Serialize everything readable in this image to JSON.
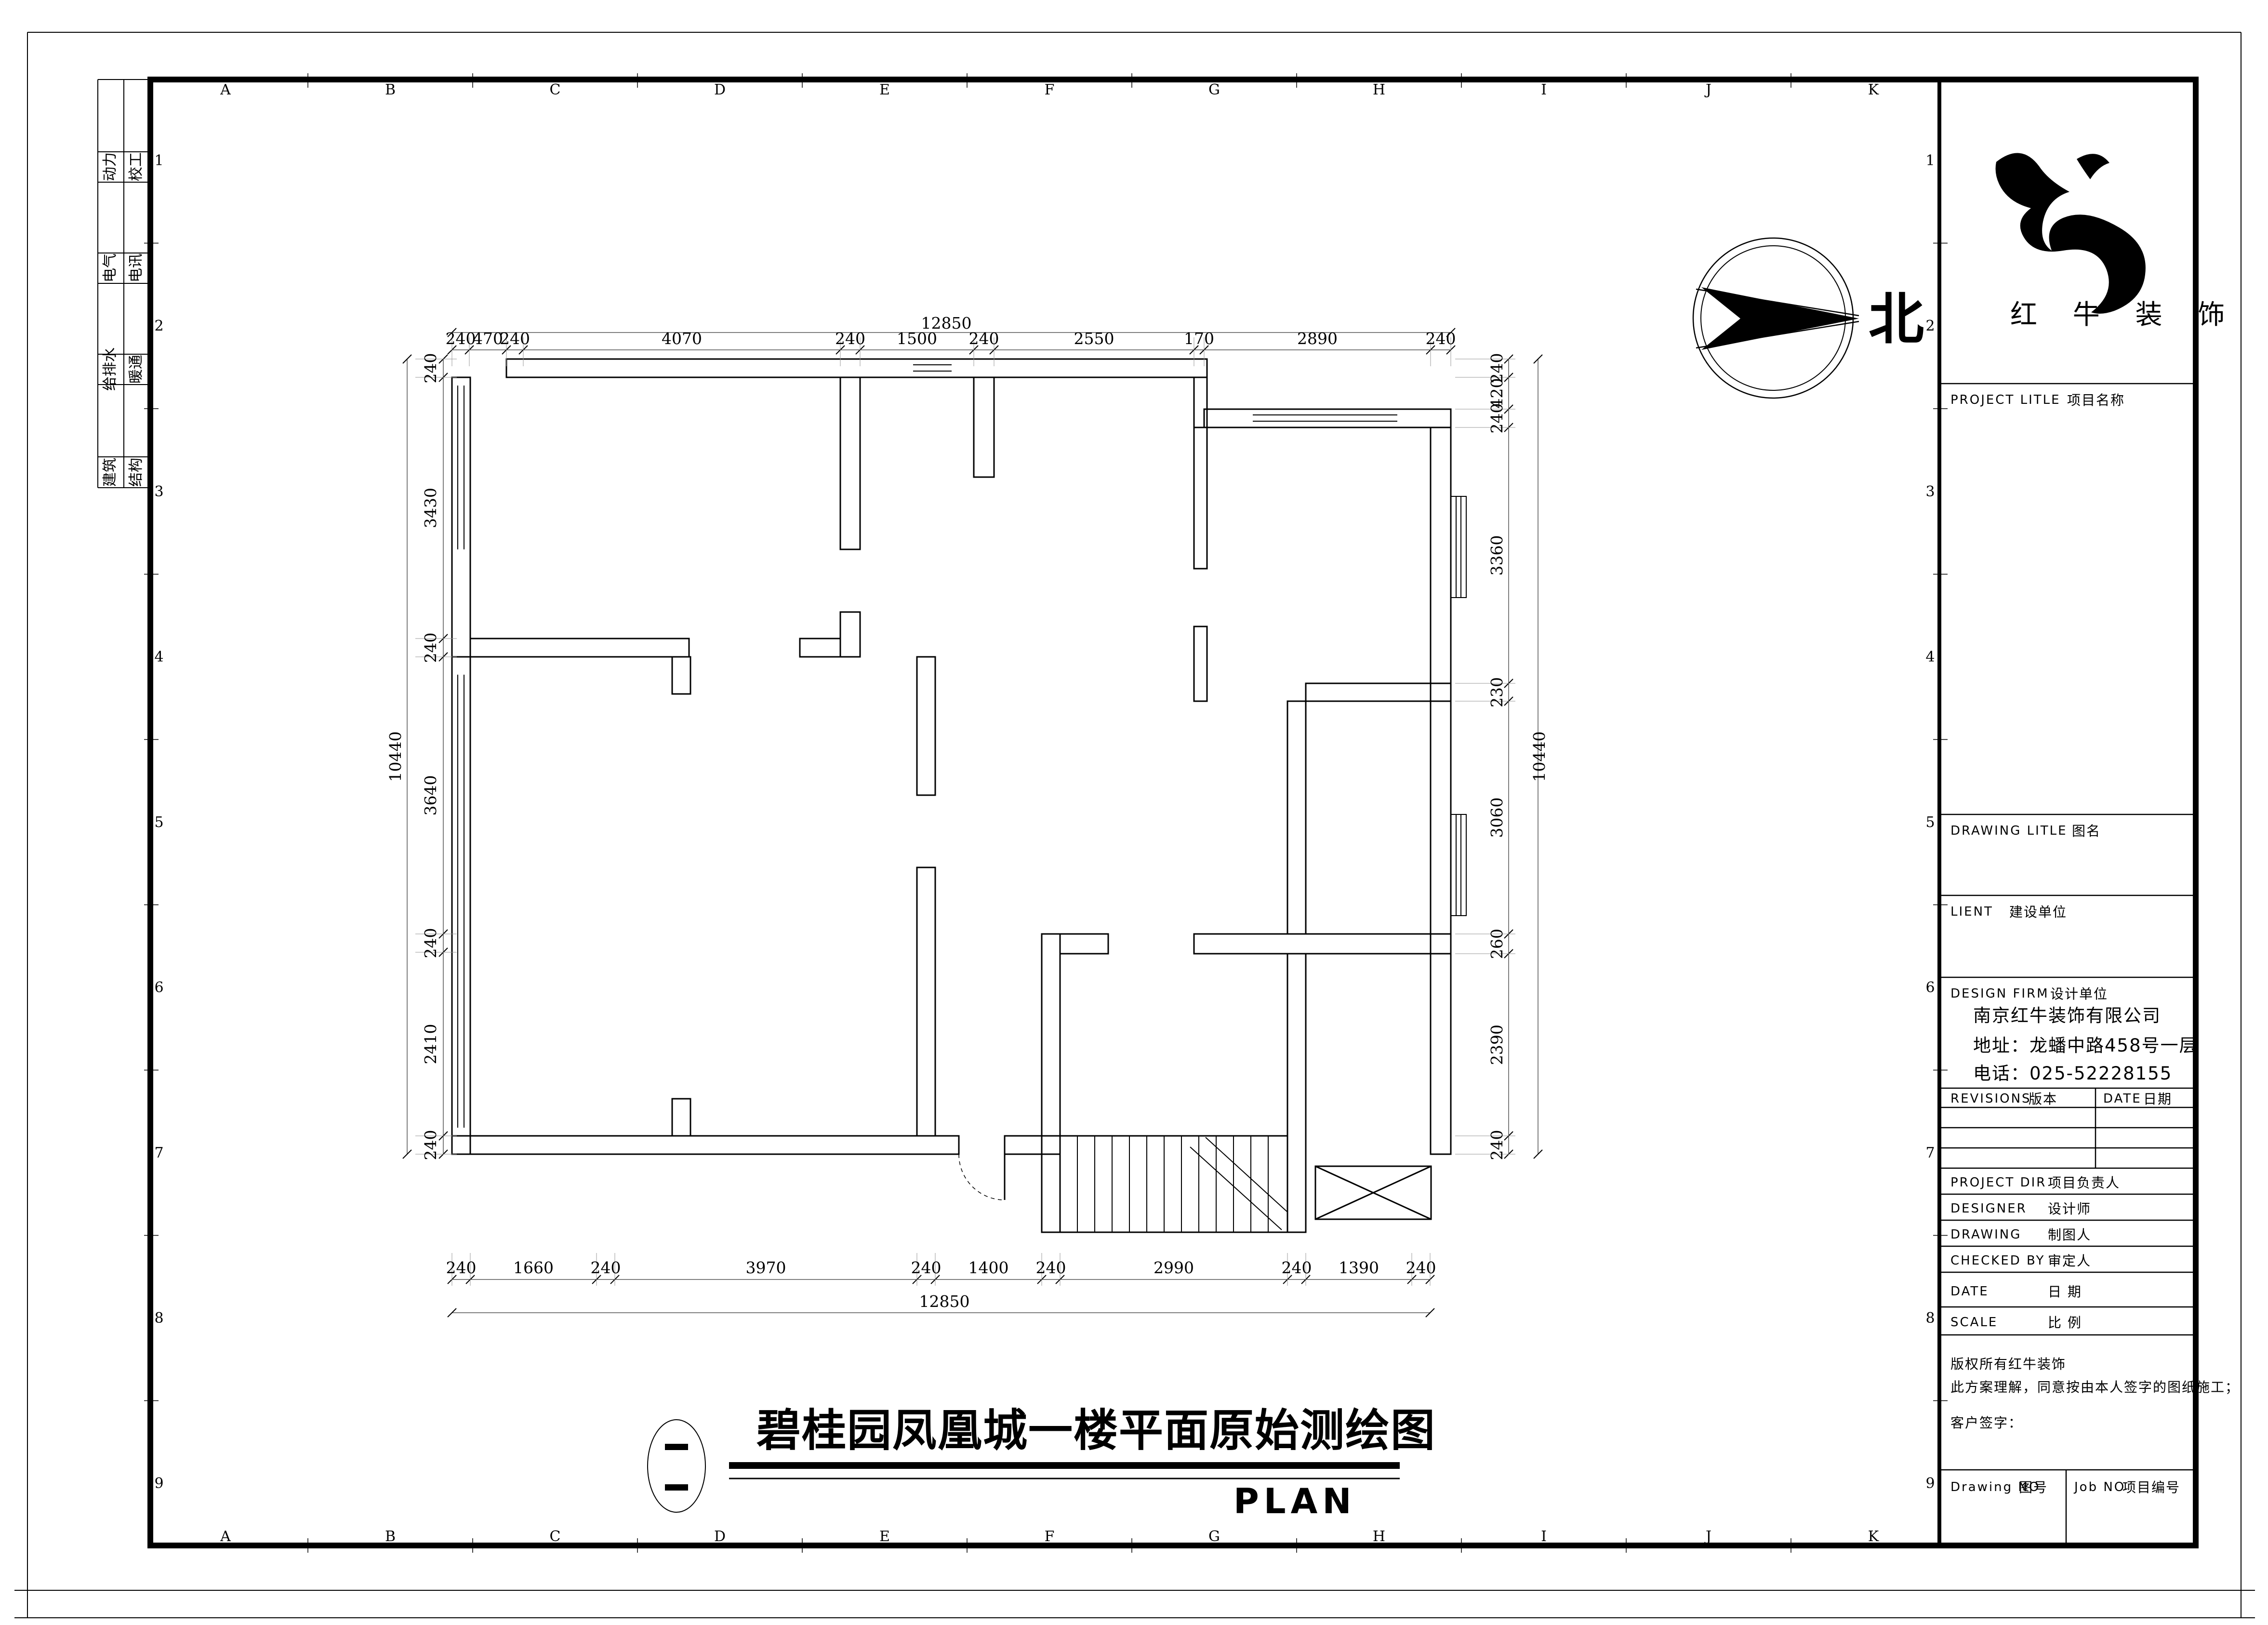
{
  "sheet": {
    "north_label": "北",
    "logo_text": "红 牛 装 饰",
    "plan_title": "碧桂园凤凰城一楼平面原始测绘图",
    "plan_subtitle": "PLAN"
  },
  "title_block": {
    "project_title_en": "PROJECT LITLE",
    "project_title_zh": "项目名称",
    "drawing_title_en": "DRAWING LITLE",
    "drawing_title_zh": "图名",
    "client_en": "LIENT",
    "client_zh": "建设单位",
    "design_firm_en": "DESIGN FIRM",
    "design_firm_zh": "设计单位",
    "company": "南京红牛装饰有限公司",
    "address": "地址：龙蟠中路458号一层",
    "phone": "电话：025-52228155",
    "revisions_en": "REVISIONS",
    "revisions_zh": "版本",
    "date_col_en": "DATE",
    "date_col_zh": "日期",
    "project_dir_en": "PROJECT DIR",
    "project_dir_zh": "项目负责人",
    "designer_en": "DESIGNER",
    "designer_zh": "设计师",
    "drawing_by_en": "DRAWING",
    "drawing_by_zh": "制图人",
    "checked_by_en": "CHECKED BY",
    "checked_by_zh": "审定人",
    "date_row_en": "DATE",
    "date_row_zh": "日  期",
    "scale_row_en": "SCALE",
    "scale_row_zh": "比  例",
    "copyright_line1": "版权所有红牛装饰",
    "copyright_line2": "此方案理解，同意按由本人签字的图纸施工；",
    "client_sign": "客户签字：",
    "drawing_no_en": "Drawing NO",
    "drawing_no_zh": "图号",
    "job_no_en": "Job NO",
    "job_no_zh": "项目编号"
  },
  "grid": {
    "letters": [
      "A",
      "B",
      "C",
      "D",
      "E",
      "F",
      "G",
      "H",
      "I",
      "J",
      "K"
    ],
    "numbers": [
      "1",
      "2",
      "3",
      "4",
      "5",
      "6",
      "7",
      "8",
      "9"
    ]
  },
  "signoff_rows": [
    {
      "left": "动力",
      "right": "校工"
    },
    {
      "left": "电气",
      "right": "电讯"
    },
    {
      "left": "给排水",
      "right": "暖通"
    },
    {
      "left": "建筑",
      "right": "结构"
    }
  ],
  "dimensions": {
    "top": {
      "overall": "12850",
      "segments": [
        "240",
        "470",
        "240",
        "4070",
        "240",
        "1500",
        "240",
        "2550",
        "170",
        "2890",
        "240"
      ]
    },
    "bottom": {
      "overall": "12850",
      "segments": [
        "240",
        "1660",
        "240",
        "3970",
        "240",
        "1400",
        "240",
        "2990",
        "240",
        "1390",
        "240"
      ]
    },
    "left": {
      "overall": "10440",
      "segments": [
        "240",
        "3430",
        "240",
        "3640",
        "240",
        "2410",
        "240"
      ]
    },
    "right": {
      "overall": "10440",
      "segments": [
        "240",
        "420",
        "240",
        "3360",
        "230",
        "3060",
        "260",
        "2390",
        "240"
      ]
    }
  }
}
